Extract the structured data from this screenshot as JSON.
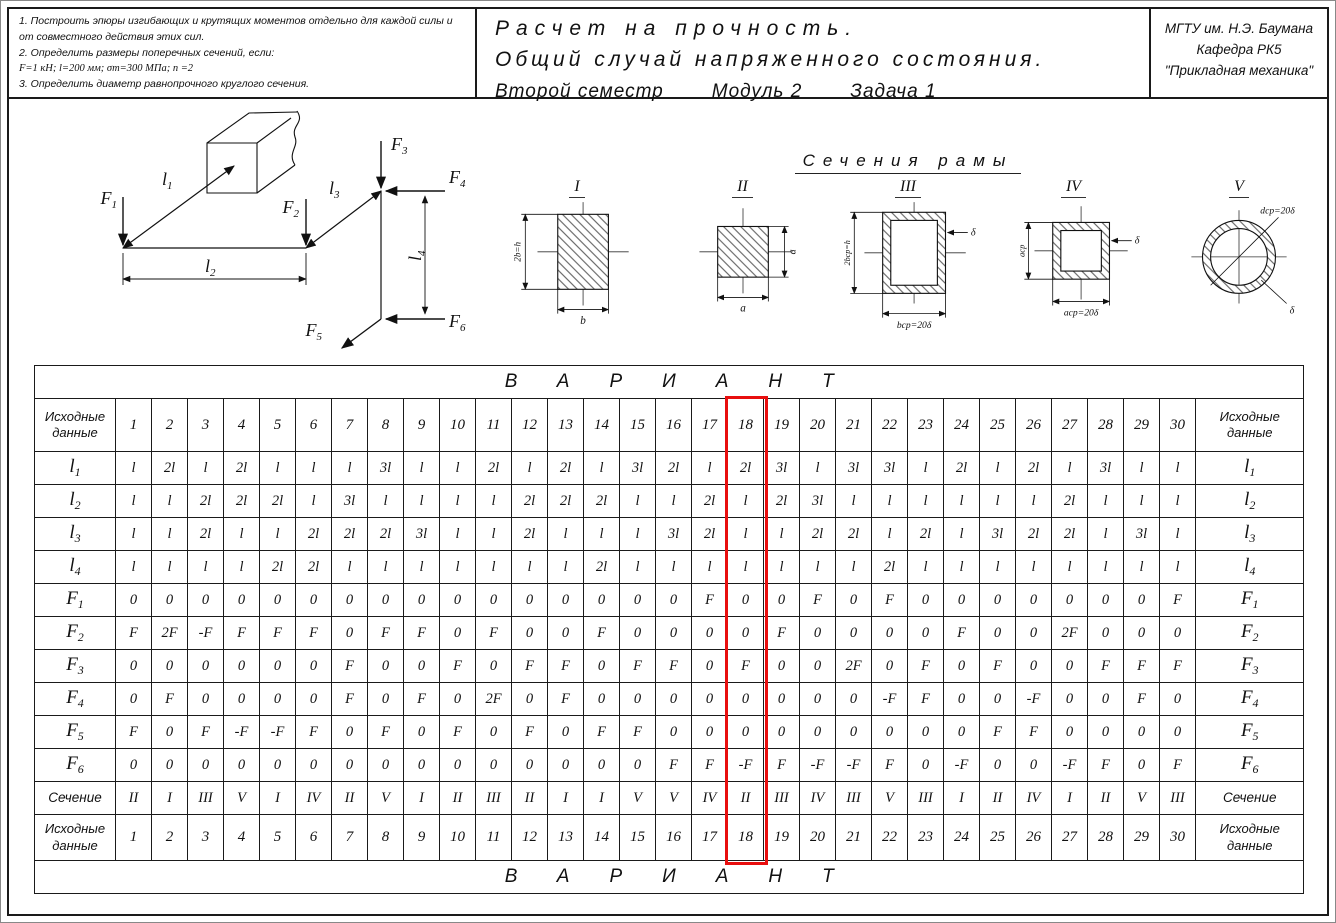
{
  "header": {
    "tasks": [
      "1.  Построить эпюры изгибающих и крутящих моментов отдельно для каждой силы и от совместного действия этих сил.",
      "2.  Определить размеры поперечных сечений,  если:",
      "F=1 кН;  l=200 мм;  σт=300 МПа;  n =2",
      "3.  Определить диаметр равнопрочного круглого сечения."
    ],
    "title_line1": "Расчет на прочность.",
    "title_line2": "Общий случай напряженного состояния.",
    "subtitle_parts": [
      "Второй семестр",
      "Модуль 2",
      "Задача 1"
    ],
    "org_line1": "МГТУ им. Н.Э. Баумана",
    "org_line2": "Кафедра РК5",
    "org_line3": "\"Прикладная механика\""
  },
  "frame": {
    "forces": [
      {
        "base": "F",
        "sub": "1"
      },
      {
        "base": "F",
        "sub": "2"
      },
      {
        "base": "F",
        "sub": "3"
      },
      {
        "base": "F",
        "sub": "4"
      },
      {
        "base": "F",
        "sub": "5"
      },
      {
        "base": "F",
        "sub": "6"
      }
    ],
    "lengths": [
      {
        "base": "l",
        "sub": "1"
      },
      {
        "base": "l",
        "sub": "2"
      },
      {
        "base": "l",
        "sub": "3"
      },
      {
        "base": "l",
        "sub": "4"
      }
    ]
  },
  "sections": {
    "title": "Сечения рамы",
    "items": [
      {
        "numeral": "I",
        "left_dim": "2b=h",
        "bottom_dim": "b"
      },
      {
        "numeral": "II",
        "right_dim": "a",
        "bottom_dim": "a"
      },
      {
        "numeral": "III",
        "left_dim": "2bср=h",
        "bottom_dim": "bср=20δ",
        "wall_dim": "δ"
      },
      {
        "numeral": "IV",
        "left_dim": "aср",
        "bottom_dim": "aср=20δ",
        "wall_dim": "δ"
      },
      {
        "numeral": "V",
        "diag_dim": "dср=20δ",
        "wall_dim": "δ"
      }
    ]
  },
  "table": {
    "variant_title": "ВАРИАНТ",
    "corner_label": "Исходные данные",
    "variants": [
      "1",
      "2",
      "3",
      "4",
      "5",
      "6",
      "7",
      "8",
      "9",
      "10",
      "11",
      "12",
      "13",
      "14",
      "15",
      "16",
      "17",
      "18",
      "19",
      "20",
      "21",
      "22",
      "23",
      "24",
      "25",
      "26",
      "27",
      "28",
      "29",
      "30"
    ],
    "highlighted_variant": "18",
    "highlight_color": "#e80e0e",
    "rows": [
      {
        "label_base": "l",
        "label_sub": "1",
        "style": "length",
        "values": [
          "l",
          "2l",
          "l",
          "2l",
          "l",
          "l",
          "l",
          "3l",
          "l",
          "l",
          "2l",
          "l",
          "2l",
          "l",
          "3l",
          "2l",
          "l",
          "2l",
          "3l",
          "l",
          "3l",
          "3l",
          "l",
          "2l",
          "l",
          "2l",
          "l",
          "3l",
          "l",
          "l"
        ]
      },
      {
        "label_base": "l",
        "label_sub": "2",
        "style": "length",
        "values": [
          "l",
          "l",
          "2l",
          "2l",
          "2l",
          "l",
          "3l",
          "l",
          "l",
          "l",
          "l",
          "2l",
          "2l",
          "2l",
          "l",
          "l",
          "2l",
          "l",
          "2l",
          "3l",
          "l",
          "l",
          "l",
          "l",
          "l",
          "l",
          "2l",
          "l",
          "l",
          "l"
        ]
      },
      {
        "label_base": "l",
        "label_sub": "3",
        "style": "length",
        "values": [
          "l",
          "l",
          "2l",
          "l",
          "l",
          "2l",
          "2l",
          "2l",
          "3l",
          "l",
          "l",
          "2l",
          "l",
          "l",
          "l",
          "3l",
          "2l",
          "l",
          "l",
          "2l",
          "2l",
          "l",
          "2l",
          "l",
          "3l",
          "2l",
          "2l",
          "l",
          "3l",
          "l"
        ]
      },
      {
        "label_base": "l",
        "label_sub": "4",
        "style": "length",
        "values": [
          "l",
          "l",
          "l",
          "l",
          "2l",
          "2l",
          "l",
          "l",
          "l",
          "l",
          "l",
          "l",
          "l",
          "2l",
          "l",
          "l",
          "l",
          "l",
          "l",
          "l",
          "l",
          "2l",
          "l",
          "l",
          "l",
          "l",
          "l",
          "l",
          "l",
          "l"
        ]
      },
      {
        "label_base": "F",
        "label_sub": "1",
        "style": "force",
        "values": [
          "0",
          "0",
          "0",
          "0",
          "0",
          "0",
          "0",
          "0",
          "0",
          "0",
          "0",
          "0",
          "0",
          "0",
          "0",
          "0",
          "F",
          "0",
          "0",
          "F",
          "0",
          "F",
          "0",
          "0",
          "0",
          "0",
          "0",
          "0",
          "0",
          "F"
        ]
      },
      {
        "label_base": "F",
        "label_sub": "2",
        "style": "force",
        "values": [
          "F",
          "2F",
          "-F",
          "F",
          "F",
          "F",
          "0",
          "F",
          "F",
          "0",
          "F",
          "0",
          "0",
          "F",
          "0",
          "0",
          "0",
          "0",
          "F",
          "0",
          "0",
          "0",
          "0",
          "F",
          "0",
          "0",
          "2F",
          "0",
          "0",
          "0"
        ]
      },
      {
        "label_base": "F",
        "label_sub": "3",
        "style": "force",
        "values": [
          "0",
          "0",
          "0",
          "0",
          "0",
          "0",
          "F",
          "0",
          "0",
          "F",
          "0",
          "F",
          "F",
          "0",
          "F",
          "F",
          "0",
          "F",
          "0",
          "0",
          "2F",
          "0",
          "F",
          "0",
          "F",
          "0",
          "0",
          "F",
          "F",
          "F"
        ]
      },
      {
        "label_base": "F",
        "label_sub": "4",
        "style": "force",
        "values": [
          "0",
          "F",
          "0",
          "0",
          "0",
          "0",
          "F",
          "0",
          "F",
          "0",
          "2F",
          "0",
          "F",
          "0",
          "0",
          "0",
          "0",
          "0",
          "0",
          "0",
          "0",
          "-F",
          "F",
          "0",
          "0",
          "-F",
          "0",
          "0",
          "F",
          "0"
        ]
      },
      {
        "label_base": "F",
        "label_sub": "5",
        "style": "force",
        "values": [
          "F",
          "0",
          "F",
          "-F",
          "-F",
          "F",
          "0",
          "F",
          "0",
          "F",
          "0",
          "F",
          "0",
          "F",
          "F",
          "0",
          "0",
          "0",
          "0",
          "0",
          "0",
          "0",
          "0",
          "0",
          "F",
          "F",
          "0",
          "0",
          "0",
          "0"
        ]
      },
      {
        "label_base": "F",
        "label_sub": "6",
        "style": "force",
        "values": [
          "0",
          "0",
          "0",
          "0",
          "0",
          "0",
          "0",
          "0",
          "0",
          "0",
          "0",
          "0",
          "0",
          "0",
          "0",
          "F",
          "F",
          "-F",
          "F",
          "-F",
          "-F",
          "F",
          "0",
          "-F",
          "0",
          "0",
          "-F",
          "F",
          "0",
          "F"
        ]
      },
      {
        "label_base": "Сечение",
        "label_sub": "",
        "style": "section",
        "values": [
          "II",
          "I",
          "III",
          "V",
          "I",
          "IV",
          "II",
          "V",
          "I",
          "II",
          "III",
          "II",
          "I",
          "I",
          "V",
          "V",
          "IV",
          "II",
          "III",
          "IV",
          "III",
          "V",
          "III",
          "I",
          "II",
          "IV",
          "I",
          "II",
          "V",
          "III"
        ]
      }
    ]
  }
}
